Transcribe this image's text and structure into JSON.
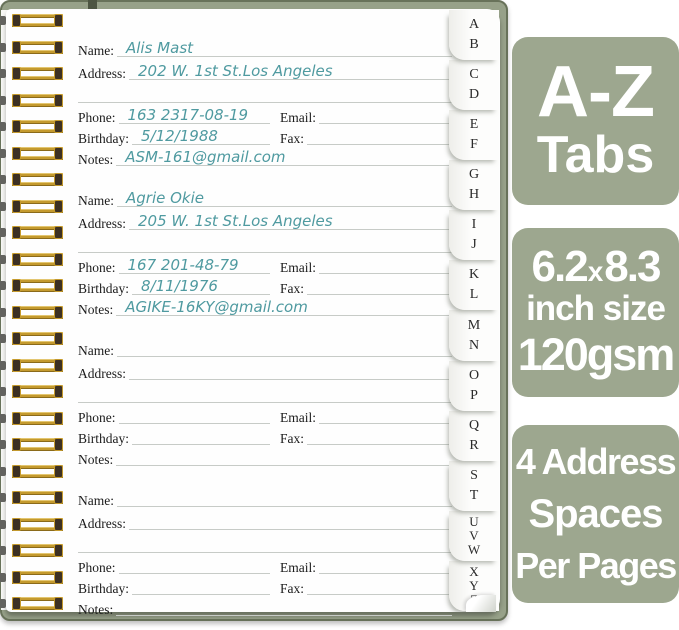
{
  "product": {
    "page_labels": {
      "name": "Name:",
      "address": "Address:",
      "phone": "Phone:",
      "email": "Email:",
      "birthday": "Birthday:",
      "fax": "Fax:",
      "notes": "Notes:"
    },
    "entries": [
      {
        "name": "Alis Mast",
        "address": "202 W. 1st St.Los Angeles",
        "phone": "163 2317-08-19",
        "email": "",
        "birthday": "5/12/1988",
        "fax": "",
        "notes": "ASM-161@gmail.com"
      },
      {
        "name": "Agrie Okie",
        "address": "205 W. 1st St.Los Angeles",
        "phone": "167 201-48-79",
        "email": "",
        "birthday": "8/11/1976",
        "fax": "",
        "notes": "AGIKE-16KY@gmail.com"
      },
      {
        "name": "",
        "address": "",
        "phone": "",
        "email": "",
        "birthday": "",
        "fax": "",
        "notes": ""
      },
      {
        "name": "",
        "address": "",
        "phone": "",
        "email": "",
        "birthday": "",
        "fax": "",
        "notes": ""
      }
    ],
    "index_tabs": [
      {
        "letters": [
          "A",
          "B"
        ]
      },
      {
        "letters": [
          "C",
          "D"
        ]
      },
      {
        "letters": [
          "E",
          "F"
        ]
      },
      {
        "letters": [
          "G",
          "H"
        ]
      },
      {
        "letters": [
          "I",
          "J"
        ]
      },
      {
        "letters": [
          "K",
          "L"
        ]
      },
      {
        "letters": [
          "M",
          "N"
        ]
      },
      {
        "letters": [
          "O",
          "P"
        ]
      },
      {
        "letters": [
          "Q",
          "R"
        ]
      },
      {
        "letters": [
          "S",
          "T"
        ]
      },
      {
        "letters": [
          "U",
          "V",
          "W"
        ]
      },
      {
        "letters": [
          "X",
          "Y",
          "Z"
        ]
      }
    ],
    "badges": {
      "az": {
        "line1": "A-Z",
        "line2": "Tabs"
      },
      "size": {
        "num1": "6.2",
        "times": "x",
        "num2": "8.3",
        "line2": "inch size",
        "line3": "120gsm"
      },
      "spaces": {
        "line1": "4 Address",
        "line2": "Spaces",
        "line3": "Per Pages"
      }
    },
    "colors": {
      "badge_green": "#9da78f",
      "cover_green": "#97a189",
      "cover_border": "#68725a",
      "handwriting_teal": "#4f9aa0",
      "wire_gold": "#c49a2e",
      "ruled_line_gray": "#c7cbc7"
    }
  }
}
